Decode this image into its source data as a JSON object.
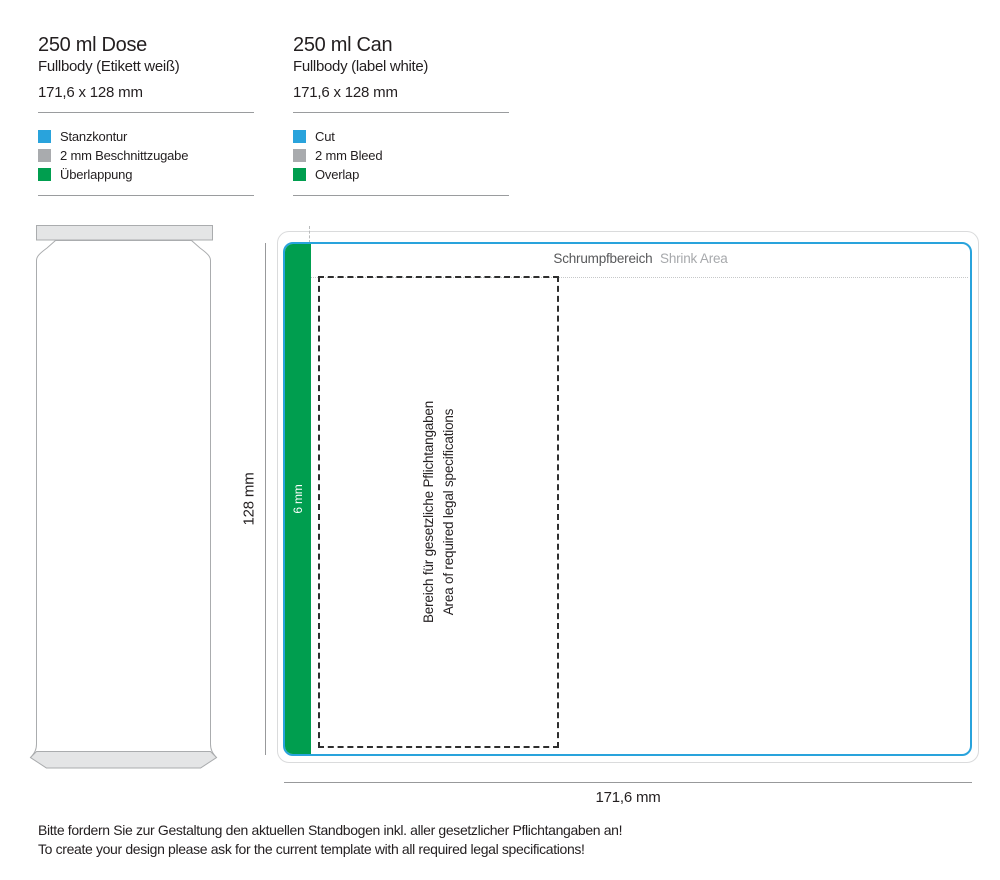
{
  "columns": {
    "de": {
      "title": "250 ml Dose",
      "subtitle": "Fullbody (Etikett weiß)",
      "dimensions": "171,6 x 128 mm",
      "legend": [
        {
          "label": "Stanzkontur",
          "color": "#29a3dc"
        },
        {
          "label": "2 mm Beschnittzugabe",
          "color": "#a9abae"
        },
        {
          "label": "Überlappung",
          "color": "#009e4f"
        }
      ]
    },
    "en": {
      "title": "250 ml Can",
      "subtitle": "Fullbody (label white)",
      "dimensions": "171,6 x 128 mm",
      "legend": [
        {
          "label": "Cut",
          "color": "#29a3dc"
        },
        {
          "label": "2 mm Bleed",
          "color": "#a9abae"
        },
        {
          "label": "Overlap",
          "color": "#009e4f"
        }
      ]
    }
  },
  "diagram": {
    "shrink_area": {
      "de": "Schrumpfbereich",
      "en": "Shrink Area"
    },
    "overlap_width": "6 mm",
    "legal_area": {
      "de": "Bereich für gesetzliche Pflichtangaben",
      "en": "Area of required legal specifications"
    },
    "height_dimension": "128 mm",
    "width_dimension": "171,6 mm",
    "colors": {
      "cut": "#29a3dc",
      "bleed": "#dadbdc",
      "overlap": "#009e4f"
    }
  },
  "footer": {
    "de": "Bitte fordern Sie zur Gestaltung den aktuellen Standbogen inkl. aller gesetzlicher Pflichtangaben an!",
    "en": "To create your design please ask for the current template with all required legal specifications!"
  }
}
